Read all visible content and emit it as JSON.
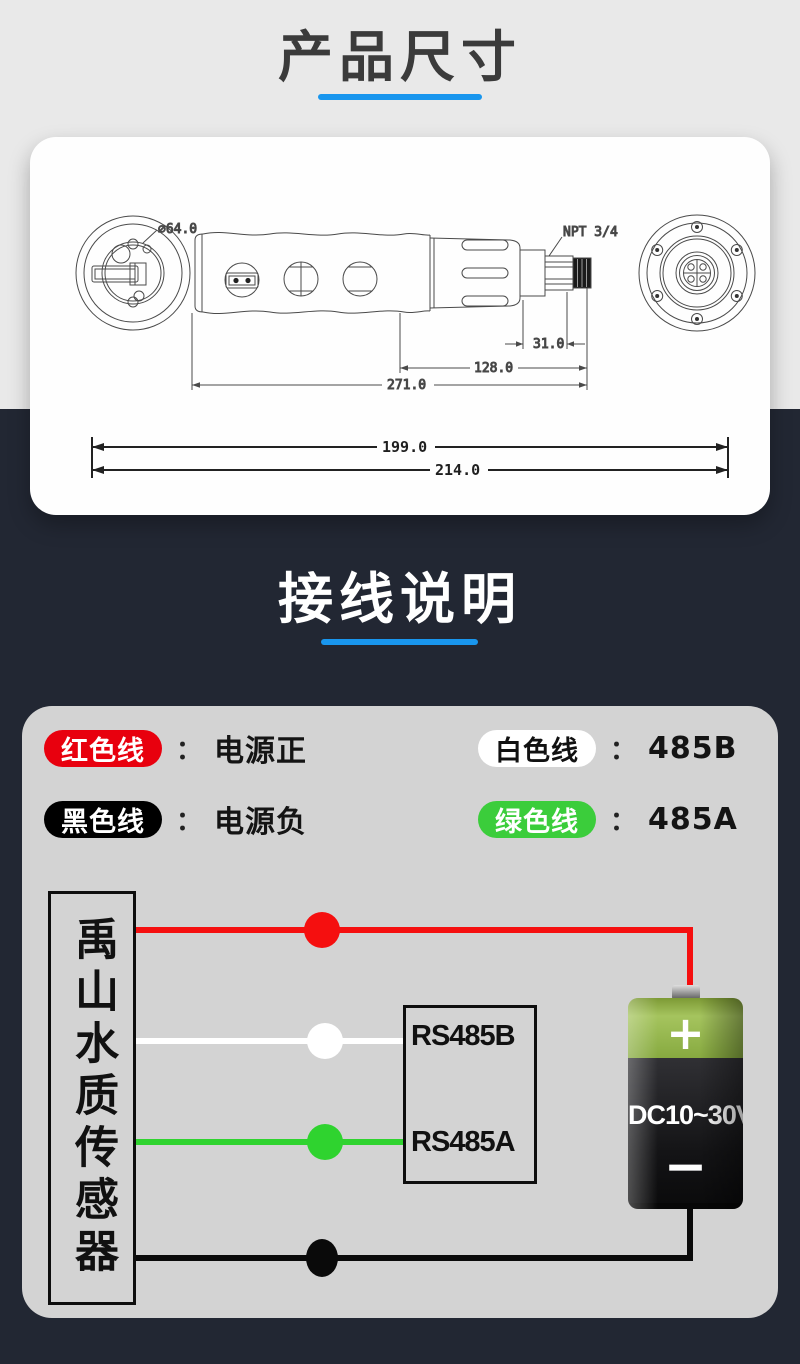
{
  "sections": {
    "dimensions_title": "产品尺寸",
    "wiring_title": "接线说明"
  },
  "dimension_diagram": {
    "diameter_label": "⌀64.0",
    "thread_label": "NPT 3/4",
    "dim_connector": "31.0",
    "dim_head": "128.0",
    "dim_body": "271.0",
    "dim_inner": "199.0",
    "dim_overall": "214.0"
  },
  "wiring": {
    "legend": [
      {
        "wire": "红色线",
        "desc": "电源正"
      },
      {
        "wire": "白色线",
        "desc": "485B"
      },
      {
        "wire": "黑色线",
        "desc": "电源负"
      },
      {
        "wire": "绿色线",
        "desc": "485A"
      }
    ],
    "colon": "：",
    "sensor_label": "禹山水质传感器",
    "rs485_box": {
      "line_b": "RS485B",
      "line_a": "RS485A"
    },
    "battery": {
      "voltage": "DC10~30V",
      "plus": "+",
      "minus": "−"
    }
  },
  "colors": {
    "accent_blue": "#1996ee",
    "bg_light": "#e9e9e9",
    "bg_dark": "#222733",
    "card_gray": "#d3d3d3",
    "pill_red": "#e8000e",
    "pill_black": "#000000",
    "pill_white": "#ffffff",
    "pill_green": "#3bcd3b",
    "wire_red": "#f50f0f",
    "wire_white": "#ffffff",
    "wire_green": "#2fd32f",
    "wire_black": "#0a0a0a",
    "battery_green": "#8db33e"
  }
}
